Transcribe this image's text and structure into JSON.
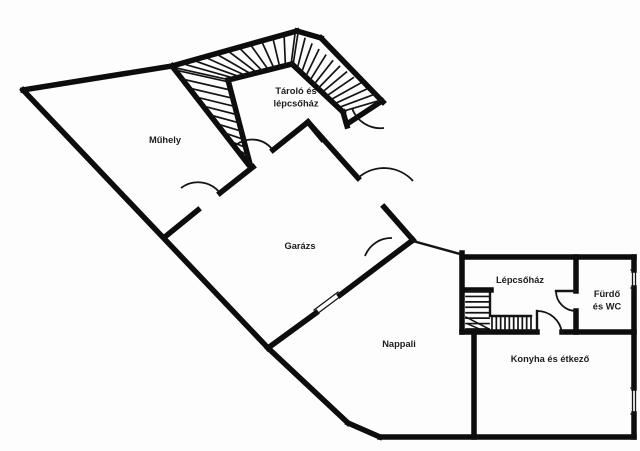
{
  "page": {
    "background": "#fdfdfd"
  },
  "colors": {
    "wall": "#0d0d0d",
    "thin": "#141414",
    "label": "#1c1c1c"
  },
  "rooms": [
    {
      "id": "muhely",
      "label": "Műhely",
      "lines": [
        "Műhely"
      ],
      "x": 165,
      "y": 140
    },
    {
      "id": "tarolo",
      "label": "Tároló és lépcsőház",
      "lines": [
        "Tároló és",
        "lépcsőház"
      ],
      "x": 296,
      "y": 97
    },
    {
      "id": "garazs",
      "label": "Garázs",
      "lines": [
        "Garázs"
      ],
      "x": 300,
      "y": 246
    },
    {
      "id": "nappali",
      "label": "Nappali",
      "lines": [
        "Nappali"
      ],
      "x": 399,
      "y": 344
    },
    {
      "id": "lepcsohaz",
      "label": "Lépcsőház",
      "lines": [
        "Lépcsőház"
      ],
      "x": 520,
      "y": 280
    },
    {
      "id": "furdo",
      "label": "Fürdő és WC",
      "lines": [
        "Fürdő",
        "és WC"
      ],
      "x": 607,
      "y": 300
    },
    {
      "id": "konyha",
      "label": "Konyha és étkező",
      "lines": [
        "Konyha és étkező"
      ],
      "x": 550,
      "y": 359
    }
  ],
  "plan": {
    "walls_thick": [
      [
        23,
        90,
        172,
        66
      ],
      [
        172,
        66,
        297,
        31
      ],
      [
        297,
        31,
        321,
        38
      ],
      [
        321,
        38,
        383,
        102
      ],
      [
        23,
        90,
        268,
        348
      ],
      [
        268,
        348,
        348,
        423
      ],
      [
        348,
        423,
        380,
        437
      ],
      [
        380,
        437,
        634,
        437
      ],
      [
        634,
        437,
        634,
        414
      ],
      [
        634,
        388,
        634,
        288
      ],
      [
        634,
        270,
        634,
        257
      ],
      [
        462,
        257,
        634,
        257
      ],
      [
        172,
        66,
        248,
        164
      ],
      [
        166,
        236,
        198,
        210
      ],
      [
        220,
        193,
        253,
        167
      ],
      [
        273,
        150,
        308,
        122
      ],
      [
        228,
        80,
        292,
        64
      ],
      [
        228,
        80,
        250,
        164
      ],
      [
        292,
        64,
        343,
        112
      ],
      [
        343,
        112,
        347,
        126
      ],
      [
        322,
        139,
        308,
        122
      ],
      [
        347,
        124,
        382,
        101
      ],
      [
        308,
        122,
        358,
        178
      ],
      [
        384,
        207,
        413,
        240
      ],
      [
        413,
        240,
        340,
        295
      ],
      [
        316,
        313,
        268,
        348
      ],
      [
        462,
        253,
        462,
        332
      ],
      [
        576,
        257,
        576,
        291
      ],
      [
        576,
        311,
        576,
        332
      ],
      [
        462,
        332,
        537,
        332
      ],
      [
        562,
        332,
        634,
        332
      ],
      [
        474,
        332,
        474,
        437
      ],
      [
        465,
        290,
        491,
        290
      ]
    ],
    "walls_thin": [
      [
        413,
        241,
        460,
        254
      ],
      [
        490,
        291,
        490,
        316
      ],
      [
        492,
        316,
        531,
        316
      ],
      [
        537,
        311,
        537,
        332
      ],
      [
        556,
        291,
        576,
        291
      ]
    ],
    "stairs": [
      {
        "e1": [
          175,
          70,
          249,
          161
        ],
        "e2": [
          229,
          82,
          250,
          164
        ],
        "n": 10
      },
      {
        "e1": [
          176,
          68,
          295,
          34
        ],
        "e2": [
          230,
          80,
          291,
          65
        ],
        "n": 11
      },
      {
        "e1": [
          298,
          33,
          381,
          100
        ],
        "e2": [
          293,
          65,
          344,
          111
        ],
        "n": 12
      },
      {
        "e1": [
          466,
          291,
          466,
          329
        ],
        "e2": [
          489,
          291,
          489,
          329
        ],
        "n": 7
      },
      {
        "e1": [
          492,
          316,
          531,
          316
        ],
        "e2": [
          492,
          331,
          531,
          331
        ],
        "n": 9
      }
    ],
    "winder_lines": [
      [
        466,
        317,
        489,
        329
      ],
      [
        468,
        324,
        484,
        331
      ]
    ],
    "doors": [
      "M 352,108 A 30 30 0 0 0 384,128",
      "M 358,178 A 39 39 0 0 1 413,181",
      "M 220,193 A 28 28 0 0 0 181,188",
      "M 272,149 A 26 26 0 0 0 236,145",
      "M 365,256 A 28 28 0 0 1 392,238",
      "M 556,291 A 20 20 0 0 0 576,311",
      "M 537,311 A 25 25 0 0 1 562,333"
    ],
    "windows": [
      {
        "lines": [
          [
            341,
            296,
            317,
            314
          ],
          [
            338,
            292,
            314,
            310
          ]
        ]
      },
      {
        "lines": [
          [
            632.5,
            270,
            632.5,
            288
          ],
          [
            635.5,
            270,
            635.5,
            288
          ],
          [
            631,
            270,
            636,
            270
          ],
          [
            631,
            288,
            636,
            288
          ]
        ]
      },
      {
        "lines": [
          [
            632.5,
            388,
            632.5,
            414
          ],
          [
            635.5,
            388,
            635.5,
            414
          ],
          [
            631,
            388,
            636,
            388
          ],
          [
            631,
            414,
            636,
            414
          ]
        ]
      }
    ]
  }
}
